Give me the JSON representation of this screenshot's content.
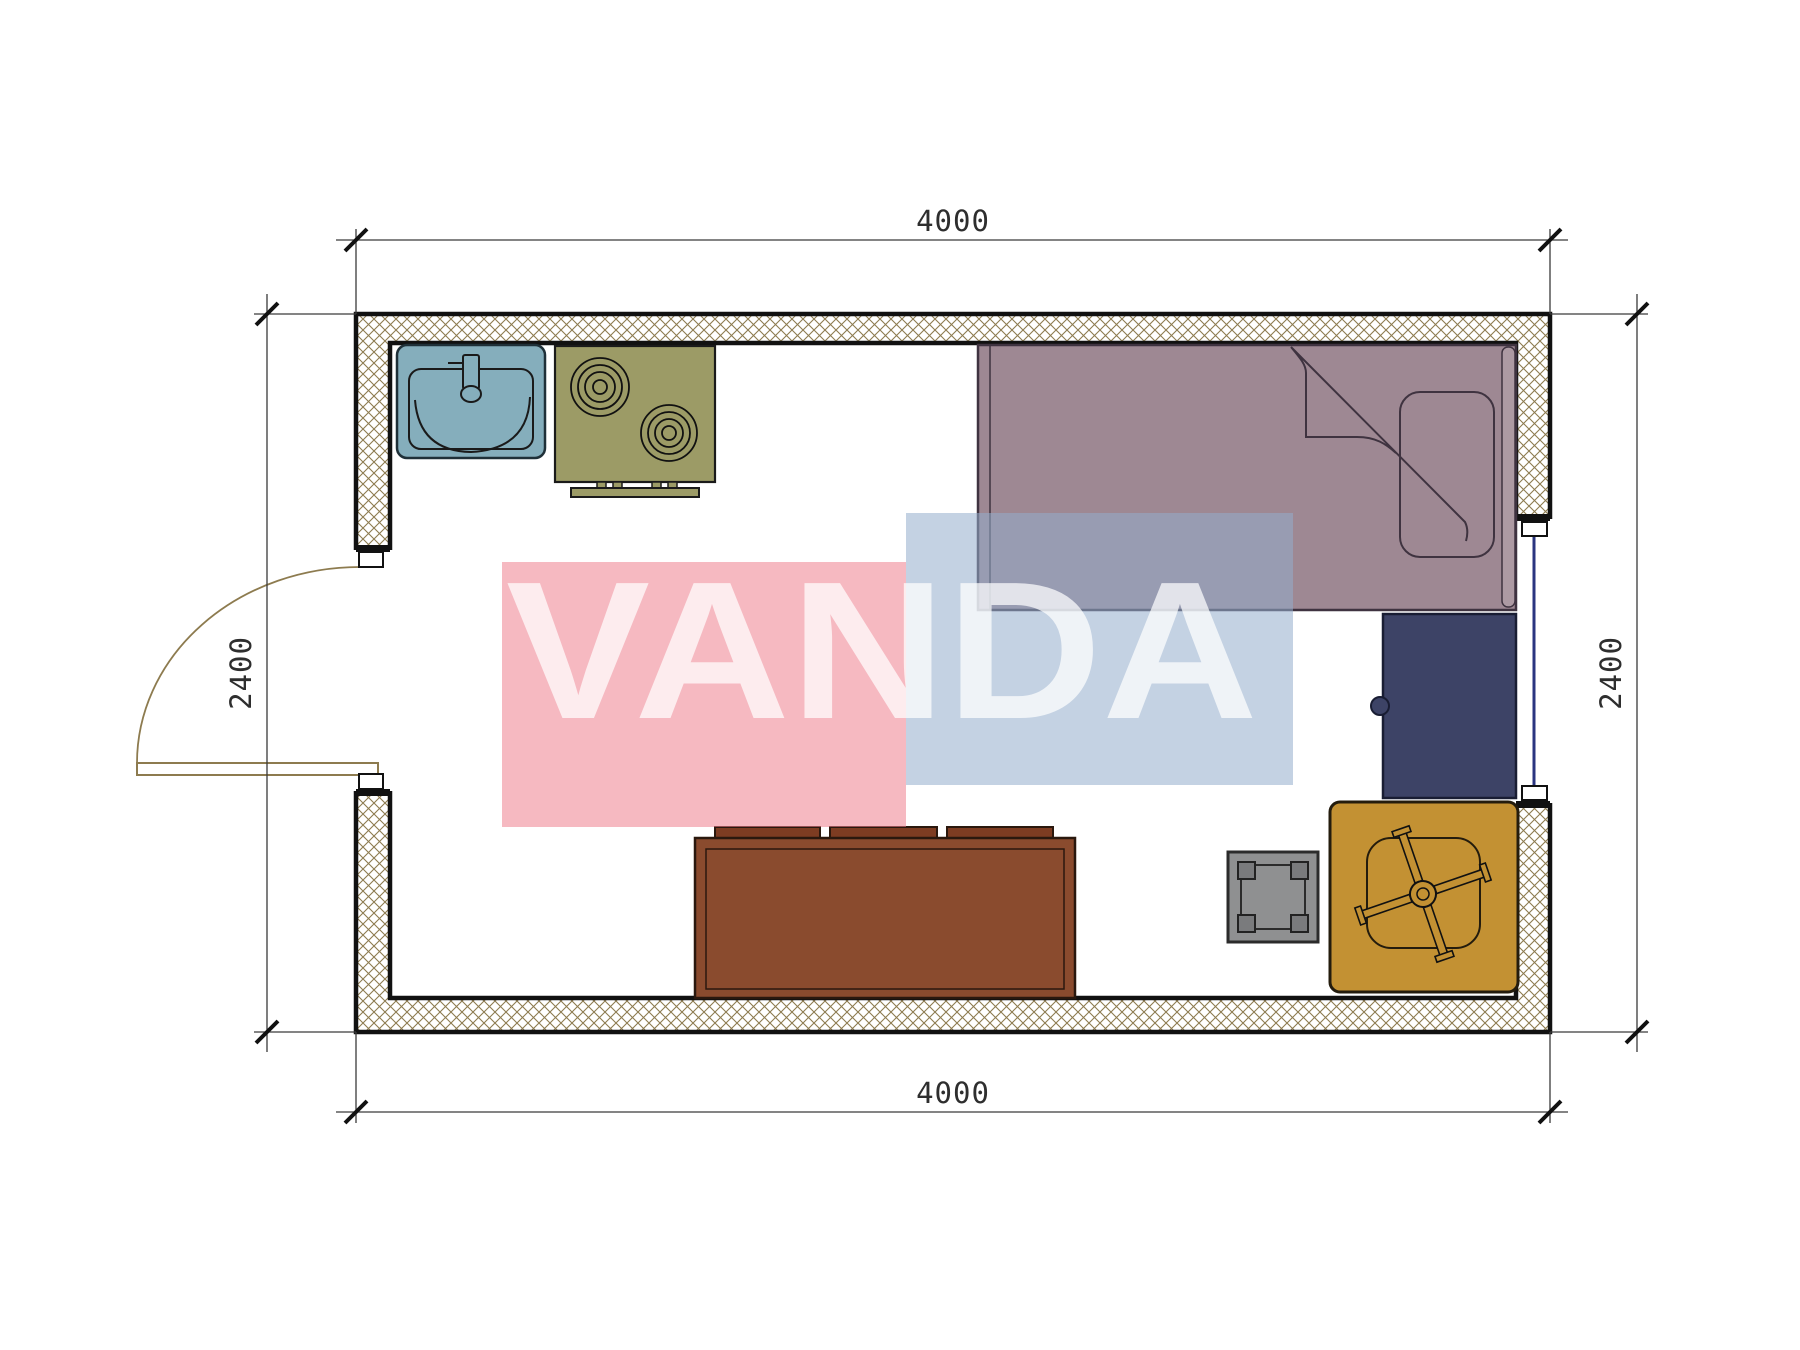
{
  "document": {
    "type": "floor-plan-drawing",
    "background": "#FFFFFF"
  },
  "dimensions": {
    "top": {
      "value": "4000"
    },
    "bottom": {
      "value": "4000"
    },
    "left": {
      "value": "2400"
    },
    "right": {
      "value": "2400"
    }
  },
  "watermark": {
    "text": "VANDA",
    "pink": "#EF808E",
    "blue": "#94ADCC",
    "text_color": "#FFFFFF"
  },
  "plan_colors": {
    "wall_hatch": "#8D7B4F",
    "wall_line": "#111111",
    "dimension_line": "#3A3A3A",
    "dimension_text": "#2E2E2E",
    "door_swing": "#8D7B4F",
    "window_glass": "#2B3580",
    "frame_cap": "#FFFFFF"
  },
  "furniture_colors": {
    "sink": "#85AEBC",
    "stove": "#9C9B66",
    "bed": "#9E8893",
    "bed_accent": "#AD9AA3",
    "desk": "#3D4366",
    "sofa": "#8A4B2E",
    "sofa_cushion": "#7D3C22",
    "stool": "#8F9091",
    "stool_post": "#7A7B7D",
    "chair_mat": "#C39133"
  }
}
